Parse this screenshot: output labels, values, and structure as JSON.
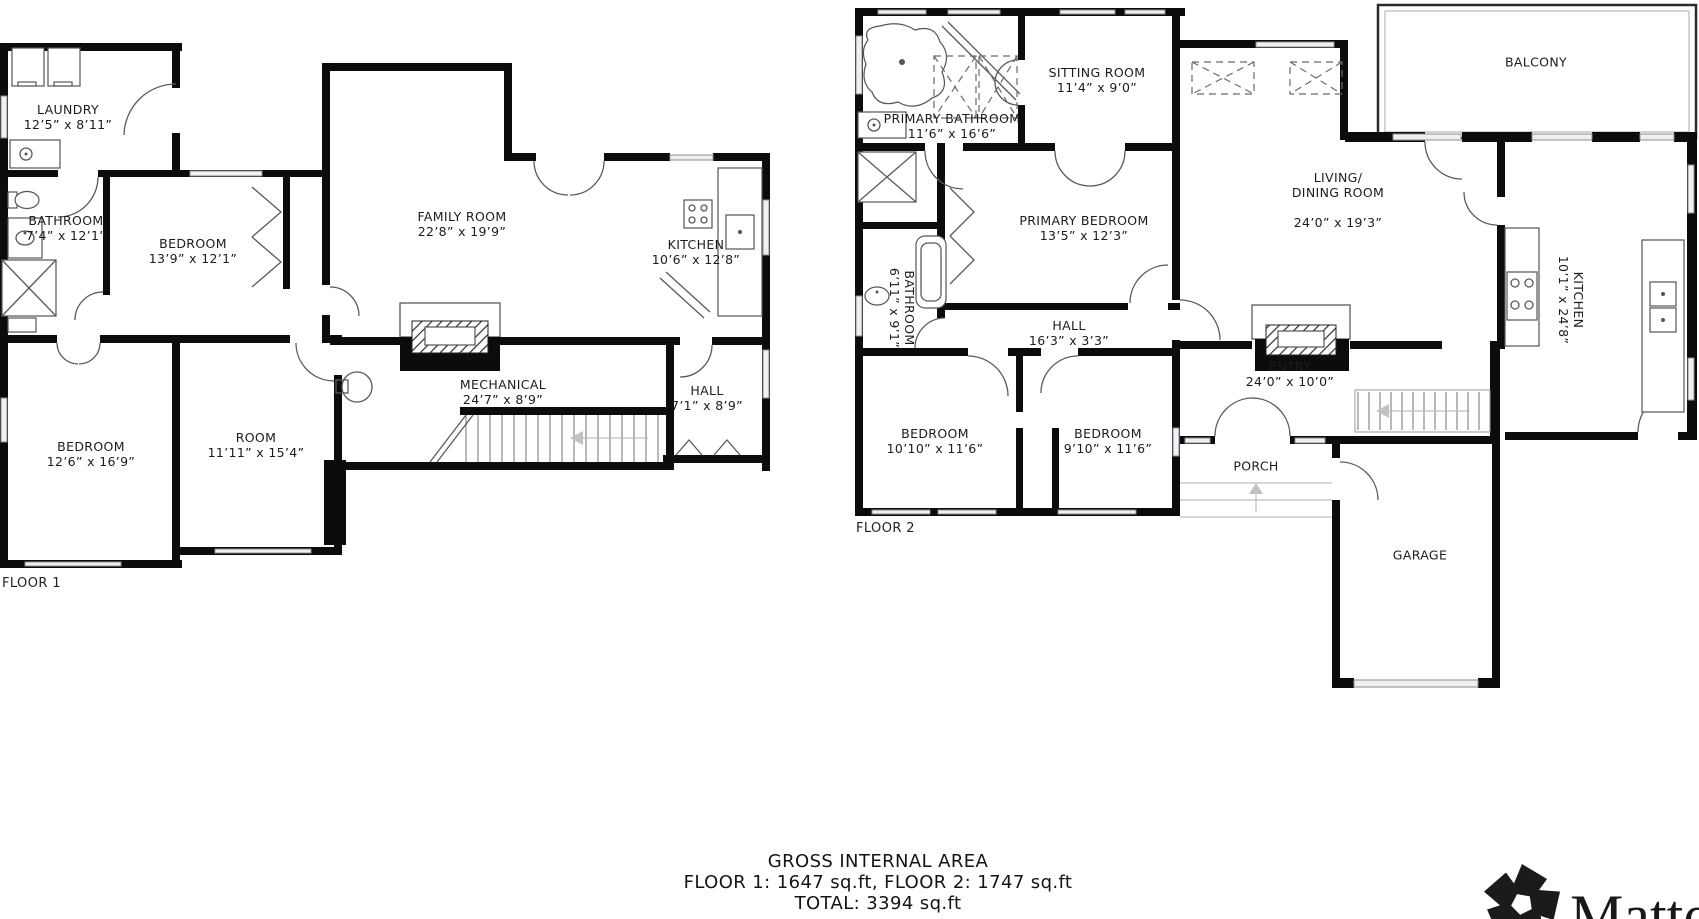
{
  "floor1": {
    "label": "FLOOR 1",
    "rooms": [
      {
        "name": "LAUNDRY",
        "dims": "12’5” x 8’11”"
      },
      {
        "name": "BATHROOM",
        "dims": "7’4” x 12’1”"
      },
      {
        "name": "BEDROOM",
        "dims": "13’9” x 12’1”"
      },
      {
        "name": "FAMILY ROOM",
        "dims": "22’8” x 19’9”"
      },
      {
        "name": "KITCHEN",
        "dims": "10’6” x 12’8”"
      },
      {
        "name": "MECHANICAL",
        "dims": "24’7” x 8’9”"
      },
      {
        "name": "HALL",
        "dims": "7’1” x 8’9”"
      },
      {
        "name": "BEDROOM",
        "dims": "12’6” x 16’9”"
      },
      {
        "name": "ROOM",
        "dims": "11’11” x 15’4”"
      }
    ]
  },
  "floor2": {
    "label": "FLOOR 2",
    "rooms": [
      {
        "name": "PRIMARY BATHROOM",
        "dims": "11’6” x 16’6”"
      },
      {
        "name": "SITTING ROOM",
        "dims": "11’4” x 9’0”"
      },
      {
        "name": "PRIMARY BEDROOM",
        "dims": "13’5” x 12’3”"
      },
      {
        "name": "BATHROOM",
        "dims": "6’11” x 9’1”"
      },
      {
        "name": "HALL",
        "dims": "16’3” x 3’3”"
      },
      {
        "name": "LIVING/\nDINING ROOM",
        "dims": "24’0” x 19’3”"
      },
      {
        "name": "KITCHEN",
        "dims": "10’1” x 24’8”"
      },
      {
        "name": "BALCONY",
        "dims": ""
      },
      {
        "name": "ENTRY",
        "dims": "24’0” x 10’0”"
      },
      {
        "name": "BEDROOM",
        "dims": "10’10” x 11’6”"
      },
      {
        "name": "BEDROOM",
        "dims": "9’10” x 11’6”"
      },
      {
        "name": "PORCH",
        "dims": ""
      },
      {
        "name": "GARAGE",
        "dims": ""
      }
    ]
  },
  "footer": {
    "line1": "GROSS INTERNAL AREA",
    "line2": "FLOOR 1: 1647  sq.ft, FLOOR 2:  1747  sq.ft",
    "line3": "TOTAL:  3394  sq.ft"
  },
  "branding": {
    "logo_text": "Matter"
  },
  "colors": {
    "wall": "#0c0c0c",
    "thin_line": "#5a5a5a",
    "window_fill": "#eef1f4",
    "background": "#ffffff"
  }
}
